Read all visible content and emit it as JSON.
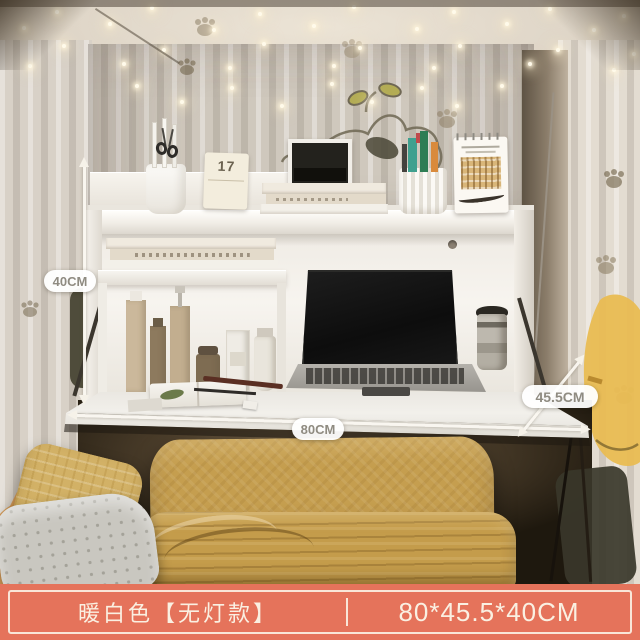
{
  "annotations": {
    "height_label": "40CM",
    "width_label": "80CM",
    "depth_label": "45.5CM"
  },
  "banner": {
    "variant_label": "暖白色【无灯款】",
    "size_label": "80*45.5*40CM"
  },
  "shelf": {
    "flip_card_day": "17"
  },
  "colors": {
    "banner_background": "#E5735B",
    "banner_text": "#FAF0E2",
    "dimension_pill_text": "#8F8B81",
    "blanket_yellow": "#C49C4B",
    "desk_white": "#F2F0EB"
  }
}
